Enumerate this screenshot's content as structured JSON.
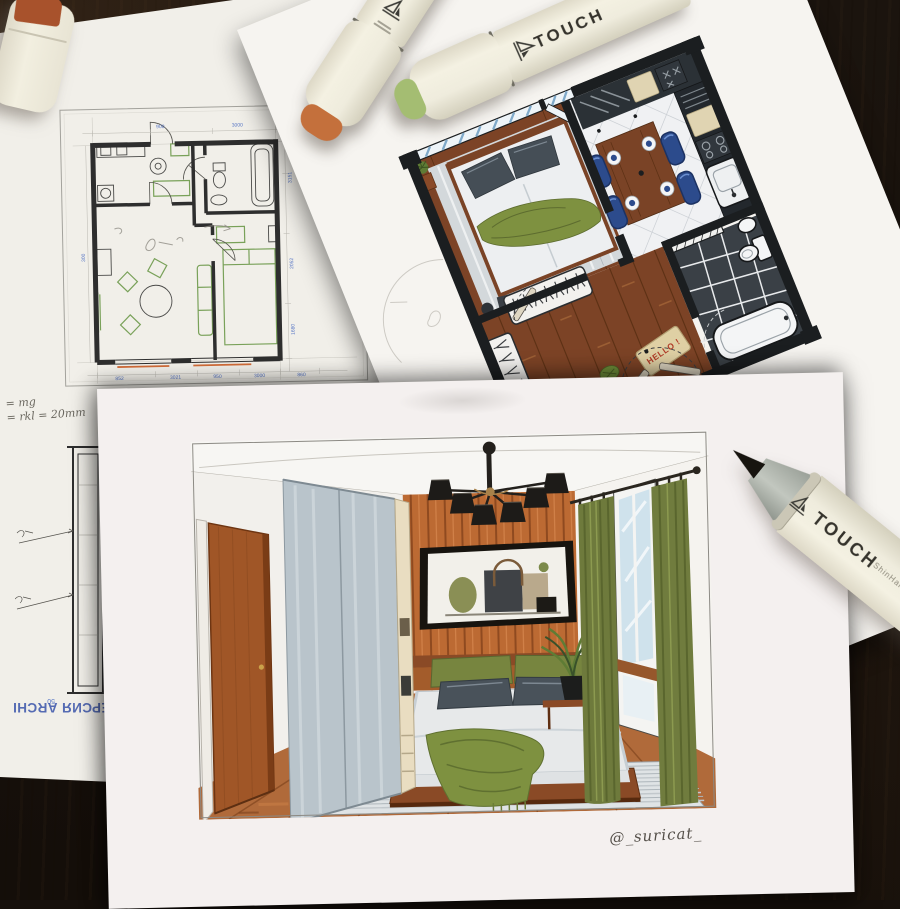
{
  "photo": {
    "signature": "@_suricat_",
    "watermark_text": "АЯ ВЕРСИЯ ARCHI"
  },
  "markers": {
    "brand": "TOUCH",
    "maker": "ShinHan",
    "body": "#efecdd",
    "orange_ring": "#c4703c",
    "green_ring": "#a4bd72",
    "nib_gray": "#a9aea6",
    "brush_black": "#17140f",
    "cap_top": "#a8522c"
  },
  "cad_plan": {
    "ink": "#2e2e2e",
    "dim_color": "#5574c4",
    "furniture_green": "#79a159",
    "accent_orange": "#d06b38",
    "dims_bottom": [
      "852",
      "3021",
      "950",
      "3000",
      "860"
    ],
    "dims_top": [
      "900",
      "3000"
    ],
    "dims_right": [
      "3151",
      "2052",
      "1680"
    ],
    "dims_left": [
      "300"
    ],
    "dim_mark": "50",
    "note_line1": "= mg",
    "note_line2": "= rkl  = 20mm"
  },
  "marker_plan": {
    "doormat": "HELLO !",
    "wall": "#1b1e20",
    "wood_floor": "#7c4326",
    "chair_navy": "#2c4b8c",
    "table_wood": "#7a4326",
    "rug": "#d3d8db",
    "throw_green": "#7e9140",
    "bath_tile": "#3a4046",
    "counter_beige": "#e0d4b2",
    "window_stripe": "#7fa9c9"
  },
  "bedroom_render": {
    "slat_wall": "#bc6a33",
    "floor": "#b06a3a",
    "curtain_olive": "#6e7a3c",
    "wardrobe_gray": "#b9c4cb",
    "door_wood": "#a05627",
    "bedding": "#e7e9ea",
    "pillow_gray": "#49525a",
    "cushion_green": "#77853f",
    "glazing_blue": "#cfe2ec"
  }
}
